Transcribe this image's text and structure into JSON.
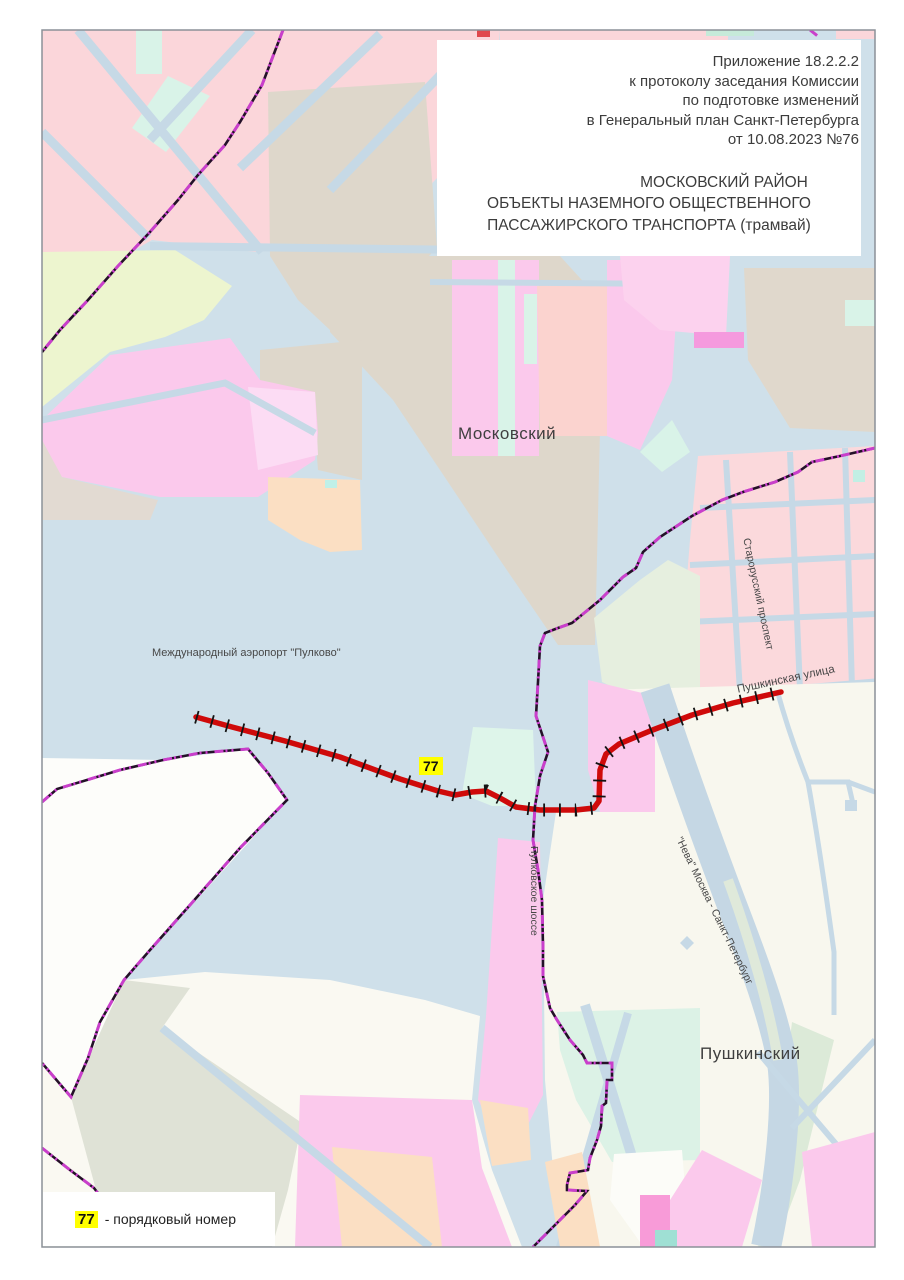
{
  "title_block": {
    "lines": [
      "Приложение 18.2.2.2",
      "к протоколу заседания Комиссии",
      "по подготовке изменений",
      "в Генеральный план Санкт-Петербурга",
      "от 10.08.2023 №76"
    ],
    "heading_lines": [
      "МОСКОВСКИЙ РАЙОН",
      "ОБЪЕКТЫ НАЗЕМНОГО ОБЩЕСТВЕННОГО",
      "ПАССАЖИРСКОГО ТРАНСПОРТА (трамвай)"
    ]
  },
  "map": {
    "district_labels": {
      "moskovsky": "Московский",
      "pushkinsky": "Пушкинский"
    },
    "place_labels": {
      "airport": "Международный аэропорт \"Пулково\""
    },
    "street_labels": {
      "starorussky": "Старорусский проспект",
      "pushkinskaya": "Пушкинская улица",
      "pulkovskoe": "Пулковское шоссе",
      "neva": "\"Нева\" Москва - Санкт-Петербург"
    },
    "route": {
      "number": "77",
      "color": "#cf0a0a",
      "label_bg": "#ffff00"
    }
  },
  "legend": {
    "symbol": "77",
    "text": "- порядковый номер",
    "symbol_bg": "#ffff00"
  },
  "colors": {
    "boundary_purple": "#c93fcb",
    "boundary_black": "#241028",
    "route_red": "#cf0a0a",
    "highlight_yellow": "#ffff00",
    "map_base": "#cfe0ea"
  }
}
